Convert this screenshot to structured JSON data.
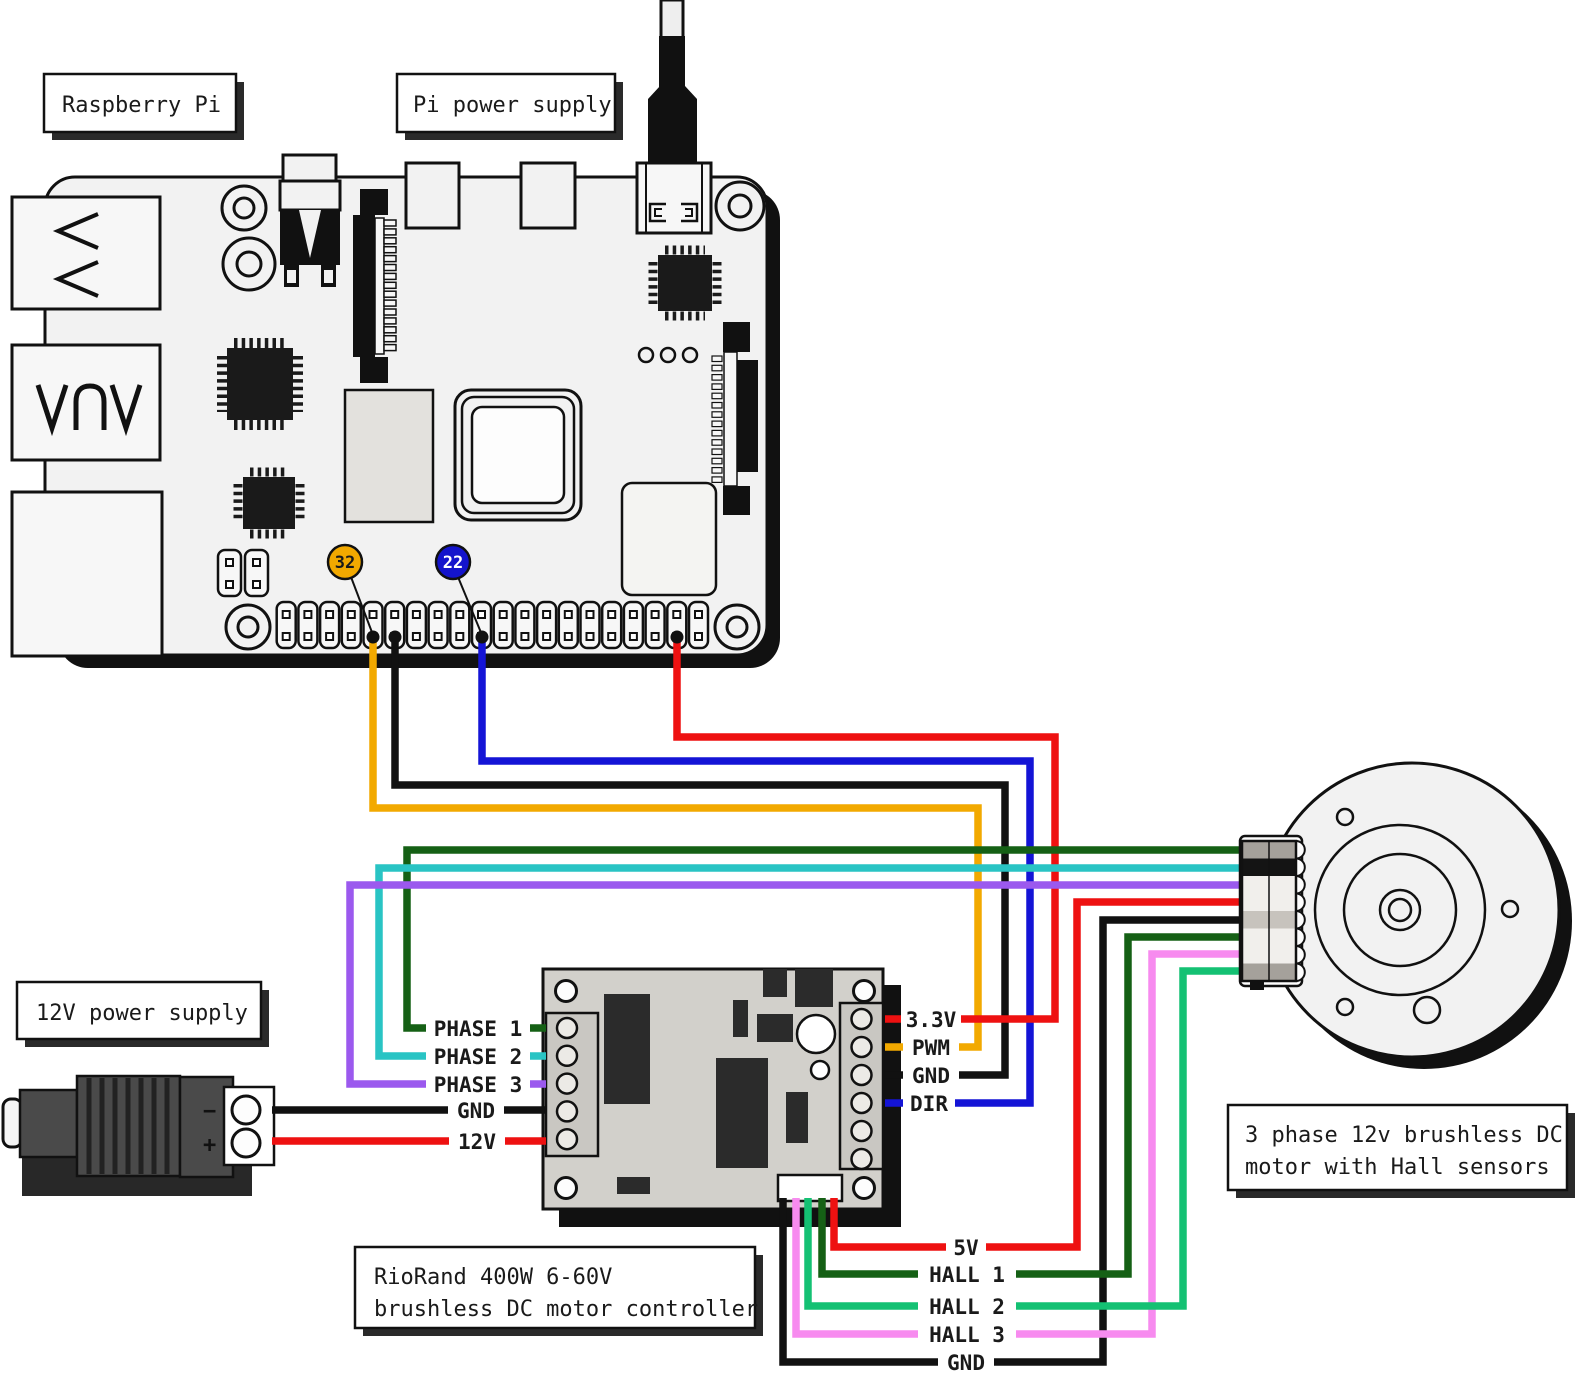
{
  "boxes": {
    "raspberry_pi": "Raspberry Pi",
    "pi_power_supply": "Pi power supply",
    "twelve_v_power_supply": "12V power supply",
    "controller_line1": "RioRand 400W 6-60V",
    "controller_line2": "brushless DC motor controller",
    "motor_line1": "3 phase 12v brushless DC",
    "motor_line2": "motor with Hall sensors"
  },
  "pi": {
    "pwm_pin_badge": "32",
    "dir_pin_badge": "22"
  },
  "power_supply_12v": {
    "negative_terminal": "−",
    "positive_terminal": "+"
  },
  "wire_labels": {
    "phase1": "PHASE 1",
    "phase2": "PHASE 2",
    "phase3": "PHASE 3",
    "gnd_input": "GND",
    "v12": "12V",
    "v33": "3.3V",
    "pwm": "PWM",
    "gnd_logic": "GND",
    "dir": "DIR",
    "v5": "5V",
    "hall1": "HALL 1",
    "hall2": "HALL 2",
    "hall3": "HALL 3",
    "gnd_hall": "GND"
  },
  "colors": {
    "phase1": "#156015",
    "phase2": "#29c4c4",
    "phase3": "#9b59ee",
    "gnd": "#111111",
    "v12": "#ee1111",
    "v33": "#ee1111",
    "v5": "#ee1111",
    "pwm": "#f2a900",
    "dir": "#1414d6",
    "hall1": "#156015",
    "hall2": "#14c173",
    "hall3": "#f78bef",
    "badge_pwm_bg": "#f2a900",
    "badge_dir_bg": "#1414cc"
  },
  "motor_connector_slots": [
    "#a5a19b",
    "#141414",
    "#f1efec",
    "#f1efec",
    "#c7c3bd",
    "#f1efec",
    "#f1efec",
    "#a5a19b"
  ]
}
